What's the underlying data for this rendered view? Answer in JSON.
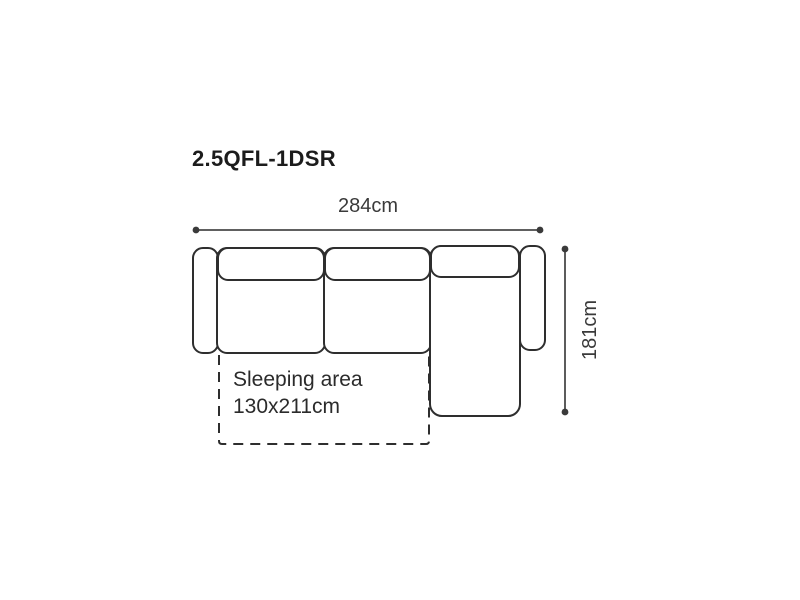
{
  "page": {
    "background": "#ffffff"
  },
  "diagram": {
    "product_code": "2.5QFL-1DSR",
    "width_dimension": "284cm",
    "height_dimension": "181cm",
    "sleeping_area_label": "Sleeping area",
    "sleeping_area_size": "130x211cm",
    "colors": {
      "outline": "#2e2e2e",
      "dimension_line": "#4a4a4a",
      "title_text": "#1c1c1c",
      "dimension_text": "#3a3a3a"
    }
  }
}
